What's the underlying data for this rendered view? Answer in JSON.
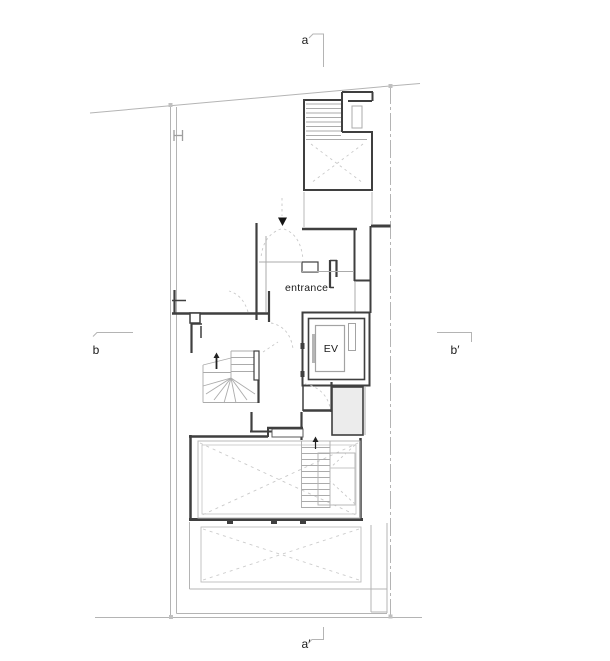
{
  "drawing": {
    "type": "architectural-floor-plan",
    "background": "#ffffff"
  },
  "colors": {
    "wall": "#3f3f3f",
    "wall_fill": "#ececec",
    "site_boundary": "#b4b4b4",
    "light_line": "#ababab",
    "dashed_line": "#c9c9c9",
    "marker_fill": "#c0c0c0",
    "text": "#1a1a1a",
    "arrow": "#151515"
  },
  "labels": {
    "section_a": "a",
    "section_a_prime": "a′",
    "section_b": "b",
    "section_b_prime": "b′",
    "entrance": "entrance",
    "elevator": "EV"
  }
}
